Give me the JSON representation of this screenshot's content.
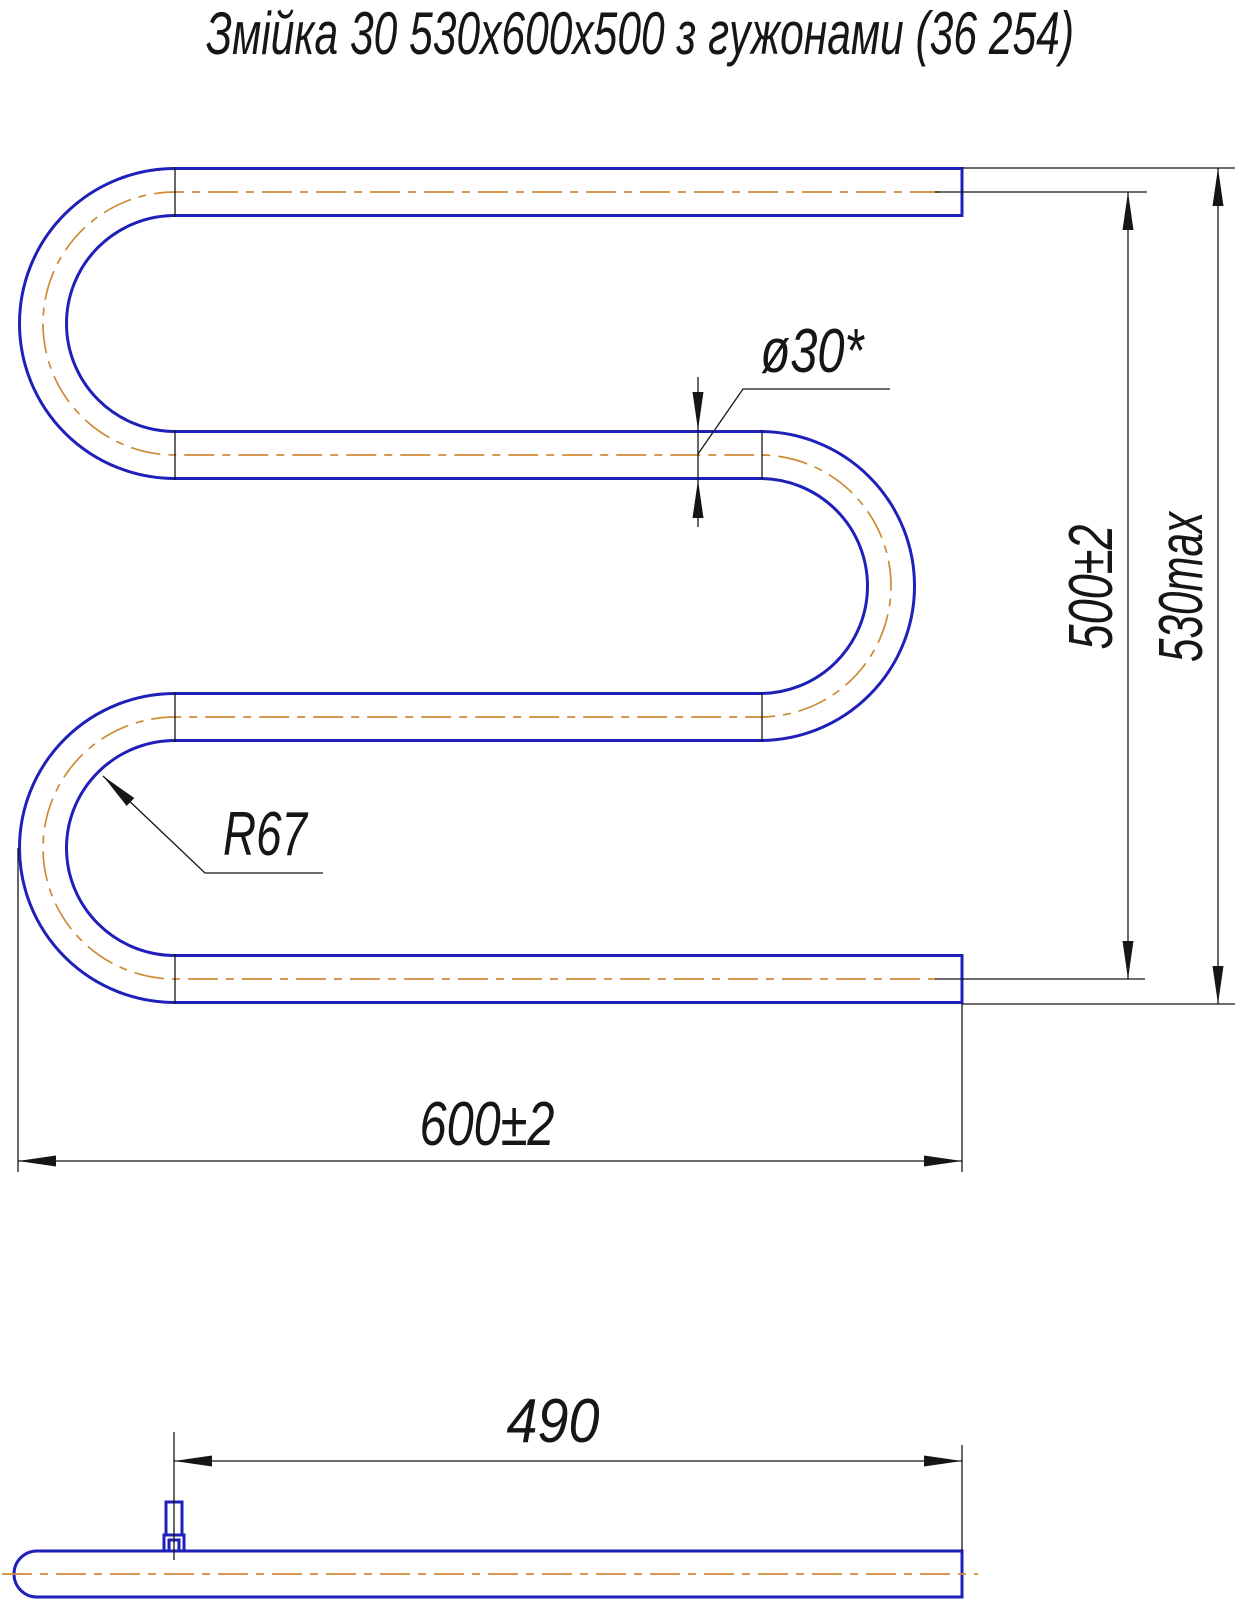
{
  "title": "Змійка 30  530х600х500 з гужонами (36 254)",
  "labels": {
    "diameter": "ø30*",
    "center_height": "500±2",
    "max_height": "530max",
    "bend_radius": "R67",
    "overall_width": "600±2",
    "stud_to_end": "490"
  },
  "colors": {
    "pipe_outline": "#1f1fb9",
    "centerline": "#cf8a36",
    "dimension_lines": "#161616",
    "background": "#ffffff"
  }
}
